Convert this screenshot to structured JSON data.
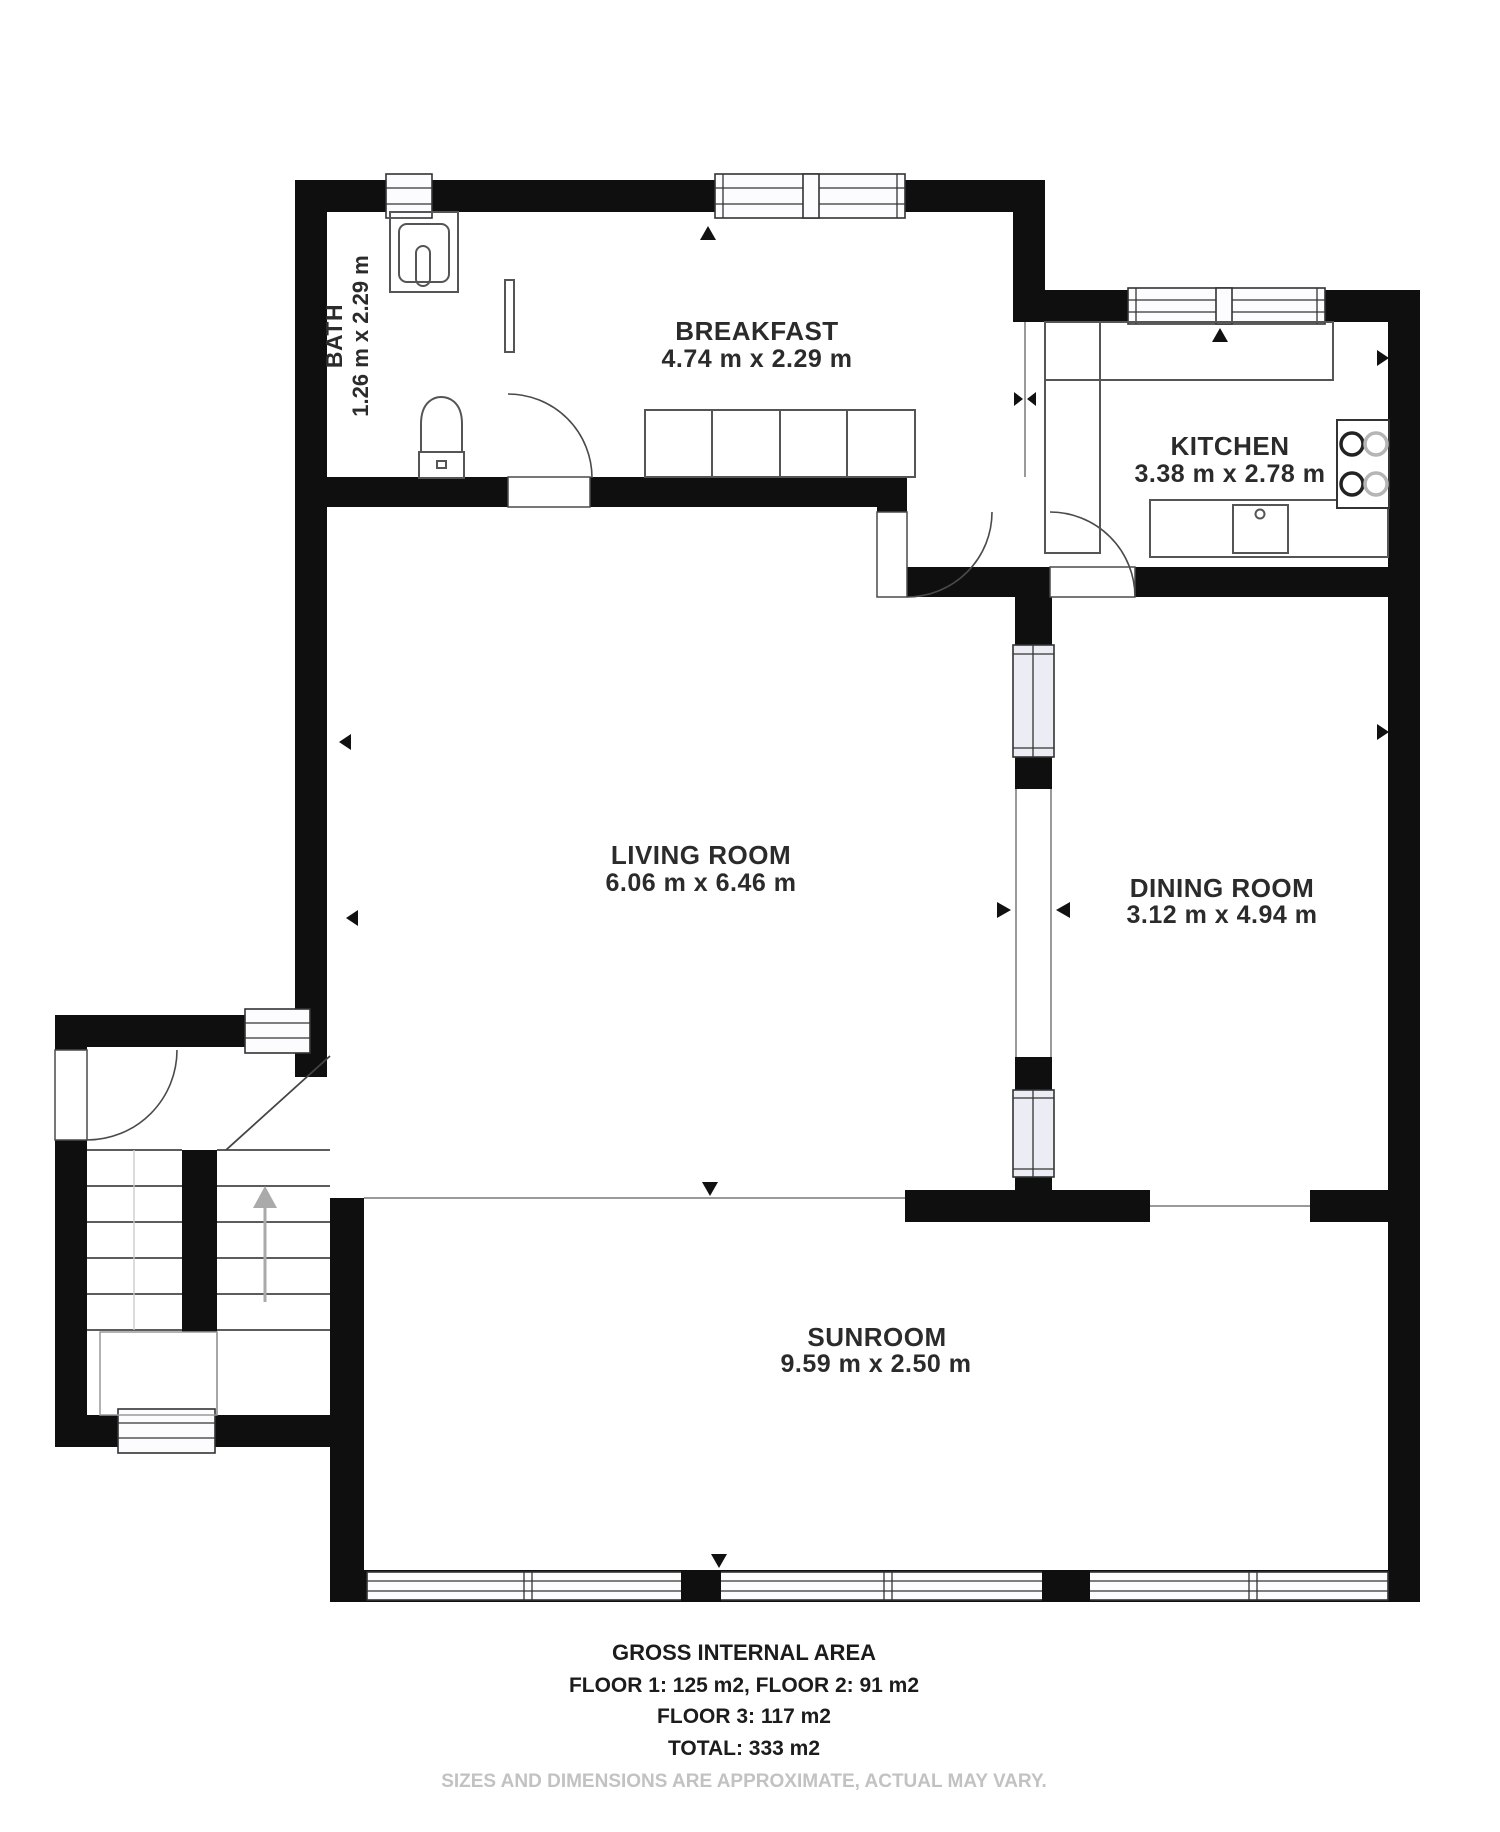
{
  "plan": {
    "rooms": {
      "bath": {
        "name": "BATH",
        "dims": "1.26 m x 2.29 m"
      },
      "breakfast": {
        "name": "BREAKFAST",
        "dims": "4.74 m x 2.29 m"
      },
      "kitchen": {
        "name": "KITCHEN",
        "dims": "3.38 m x 2.78 m"
      },
      "living": {
        "name": "LIVING ROOM",
        "dims": "6.06 m x 6.46 m"
      },
      "dining": {
        "name": "DINING ROOM",
        "dims": "3.12 m x 4.94 m"
      },
      "sunroom": {
        "name": "SUNROOM",
        "dims": "9.59 m x 2.50 m"
      }
    },
    "footer": {
      "title": "GROSS INTERNAL AREA",
      "line1": "FLOOR 1: 125 m2, FLOOR 2: 91 m2",
      "line2": "FLOOR 3: 117 m2",
      "total": "TOTAL: 333 m2",
      "disclaimer": "SIZES AND DIMENSIONS ARE APPROXIMATE, ACTUAL MAY VARY."
    },
    "colors": {
      "wall": "#0f0f0f",
      "interior_window_fill": "#ececf5",
      "disclaimer_gray": "#c2c2c2"
    }
  }
}
